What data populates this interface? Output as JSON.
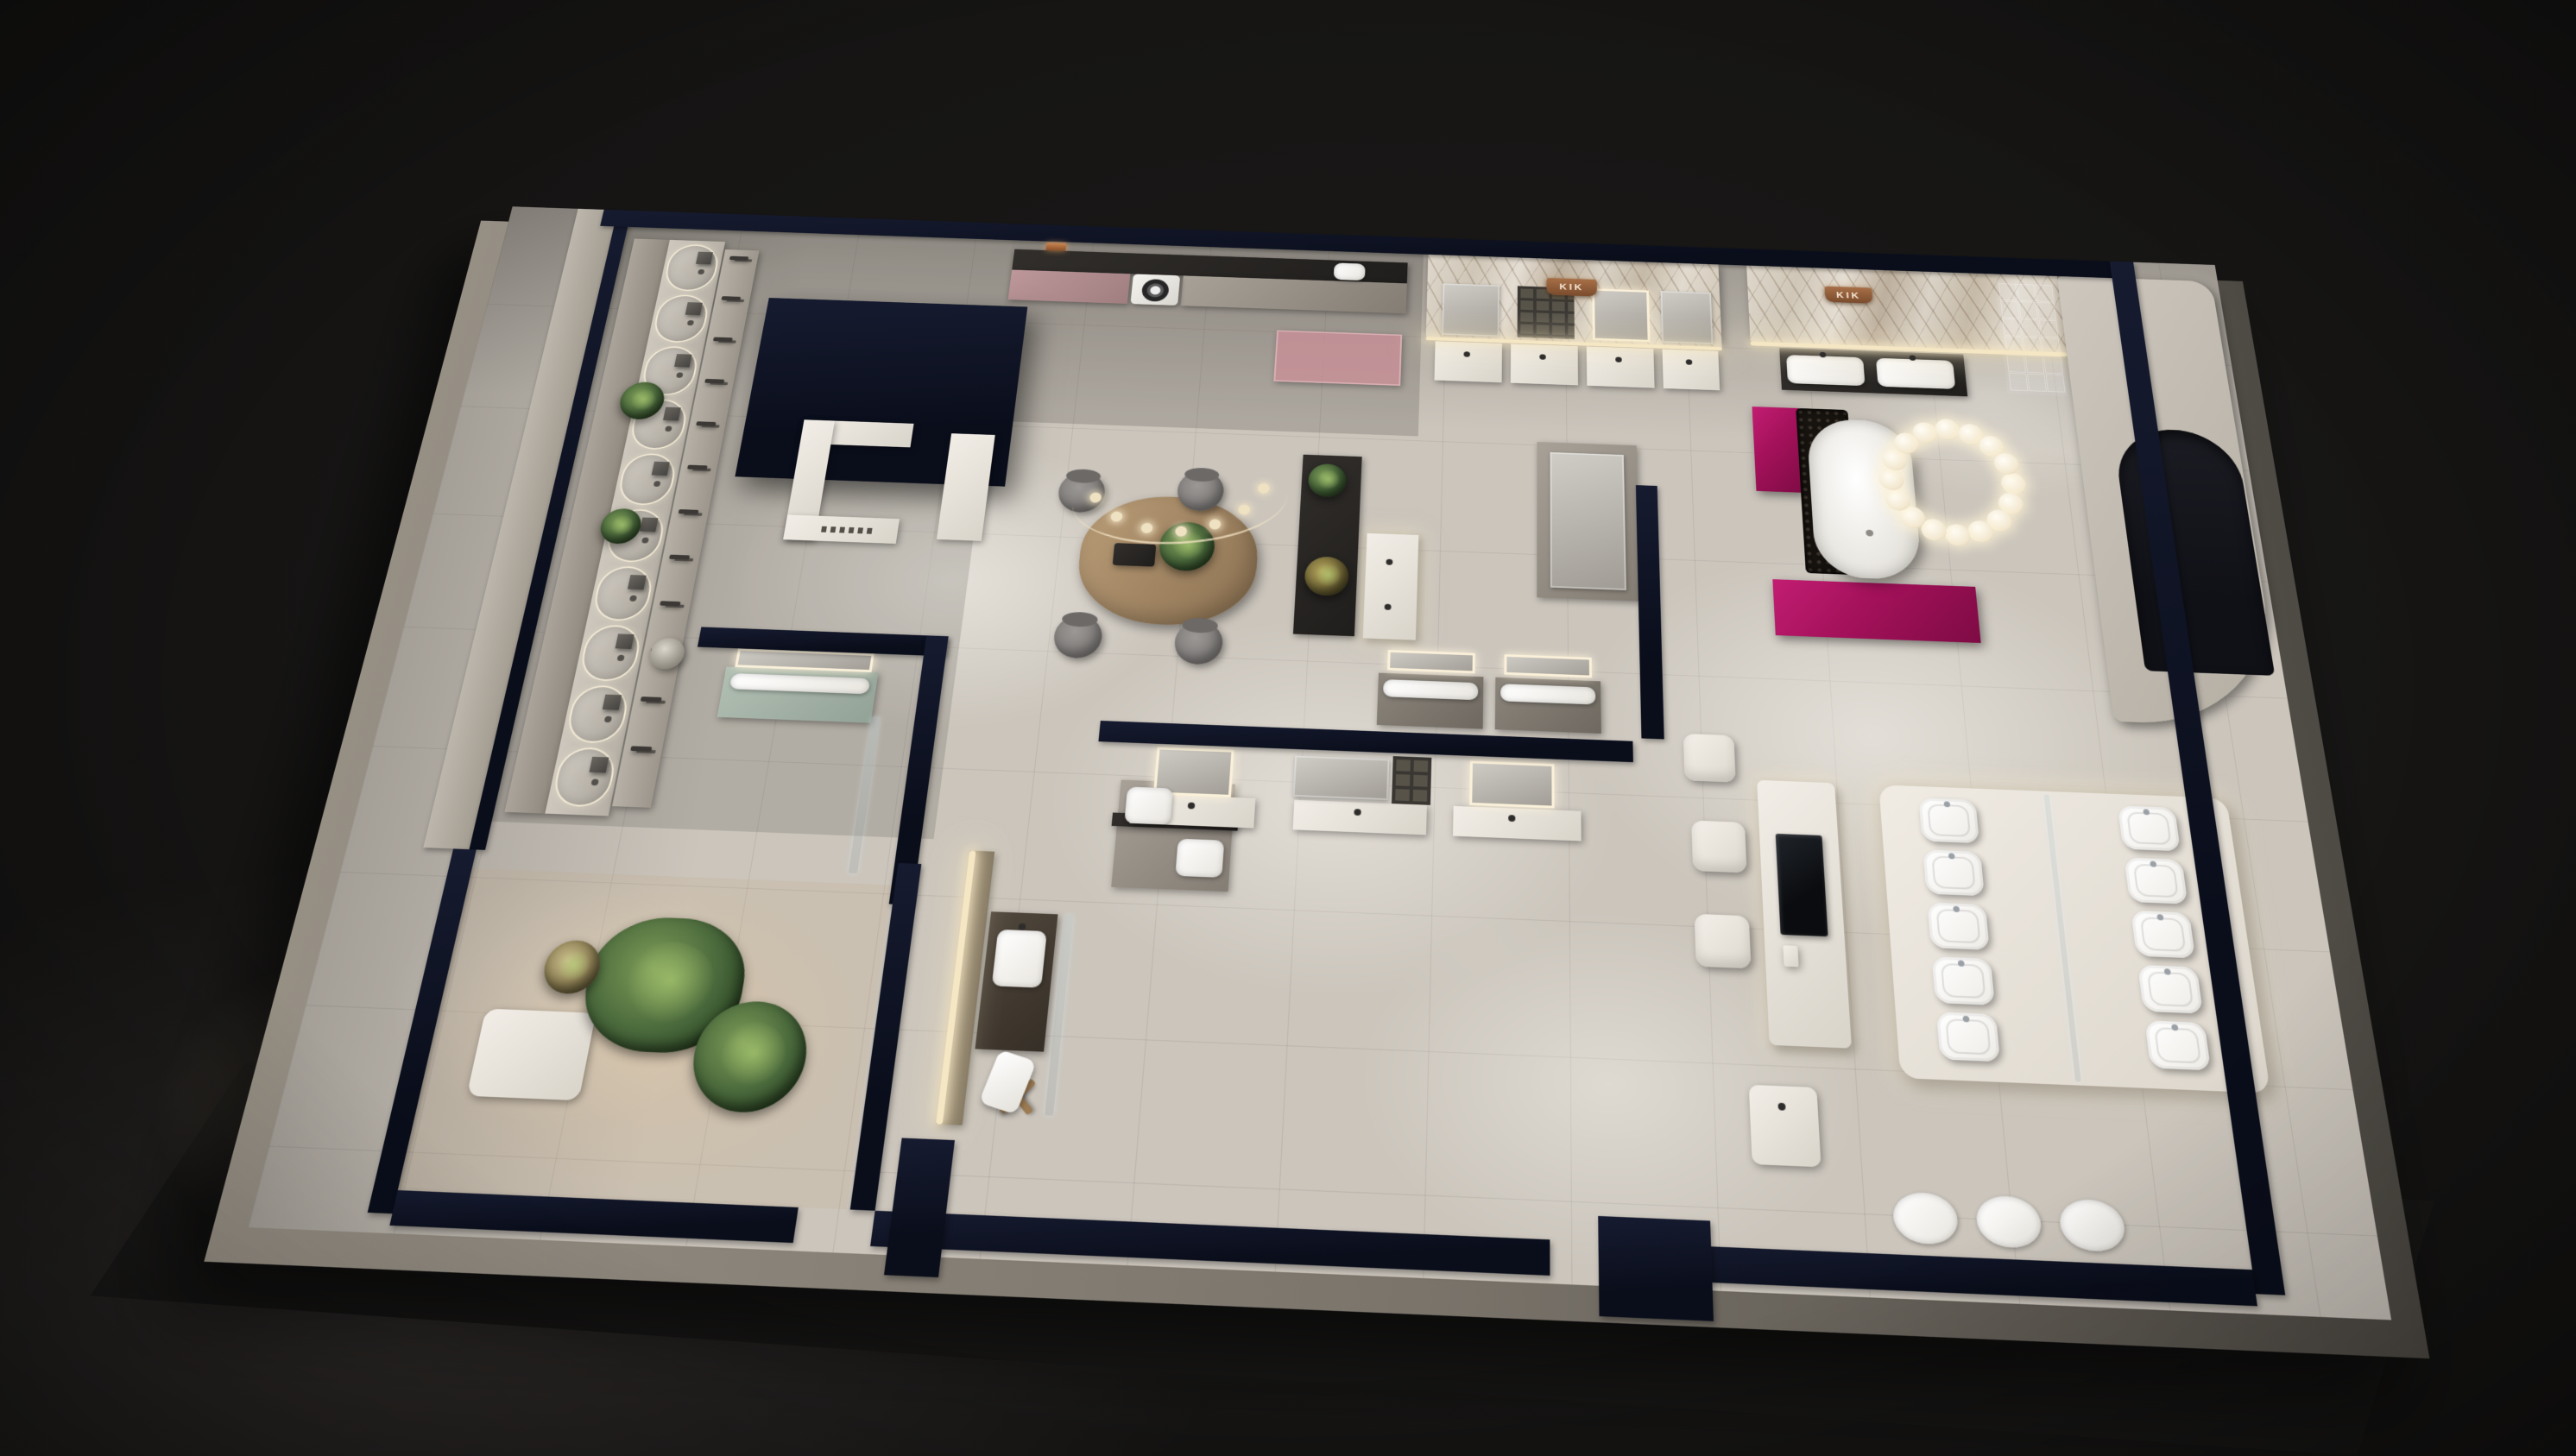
{
  "meta": {
    "type": "3d-architectural-render",
    "subject": "Bathroom sanitary-ware showroom, night aerial cutaway floor plan",
    "view": "bird's-eye oblique"
  },
  "branding": {
    "feature_wall_sign": "KIK",
    "bath_suite_sign": "KIK",
    "counter_sign_legible": false
  },
  "palette": {
    "backdrop": "#141312",
    "cut_wall": "#0c101d",
    "floor_tile": "#cbc5bc",
    "exterior_wall": "#8a8177",
    "marble": "#d8d1c5",
    "accent_magenta": "#a3115a",
    "rose_cabinet": "#b18d8f",
    "pink_glass": "#c88f96",
    "sage": "#a9b8ac",
    "wood": "#ab8f6d",
    "warm_led": "#f6e7c4"
  },
  "zones": {
    "shower_gallery": {
      "label": "Shower display wall",
      "bays": 10,
      "faucet_stands": 12,
      "plants": 2,
      "floor_lamp": 1
    },
    "service_counter": {
      "label": "Service counter under navy canopy",
      "sign_legible": false
    },
    "laundry": {
      "label": "Laundry and kitchen display",
      "washer": 1,
      "rose_cabinets": 1,
      "pink_glass_screen": 1
    },
    "feature_wall": {
      "label": "Marble feature wall",
      "sign": "KIK",
      "vanity_units": 4
    },
    "bath_suite": {
      "label": "Feature bath suite",
      "sign": "KIK",
      "freestanding_tub": 1,
      "ring_chandelier_spheres": 16,
      "magenta_units": 2,
      "double_vanity": 1,
      "glass_block_cols": 3,
      "glass_block_rows": 6,
      "arched_niche": 1
    },
    "consultation": {
      "label": "Consultation area",
      "table": 1,
      "chairs": 4,
      "pendant_spotlights": 7,
      "plants": 2,
      "tray_cups": 2
    },
    "central_partition": {
      "label": "Central vanity partition",
      "front_vanities": 3,
      "back_vanities": 2
    },
    "toilet_display": {
      "label": "Toilet display platform",
      "rows": 5,
      "columns": 2,
      "glass_divider": true
    },
    "smart_desk": {
      "label": "Interactive display desk",
      "screens": 1,
      "cube_chairs": 2,
      "side_table": 1
    },
    "mockup_bath": {
      "label": "Mock-up bathroom",
      "vanity": 1,
      "stool": 1,
      "towel": 1,
      "backlit_panel": 1
    },
    "sage_room": {
      "label": "Sage vanity room",
      "vanity": 1,
      "glass_screen": 1
    },
    "garden_room": {
      "label": "Indoor garden lounge",
      "plants": 3,
      "planter": 1
    },
    "wall_basins": {
      "label": "Wall-hung basin row",
      "count": 3
    },
    "pedestal_basin": {
      "label": "Pedestal basin",
      "count": 1
    }
  }
}
